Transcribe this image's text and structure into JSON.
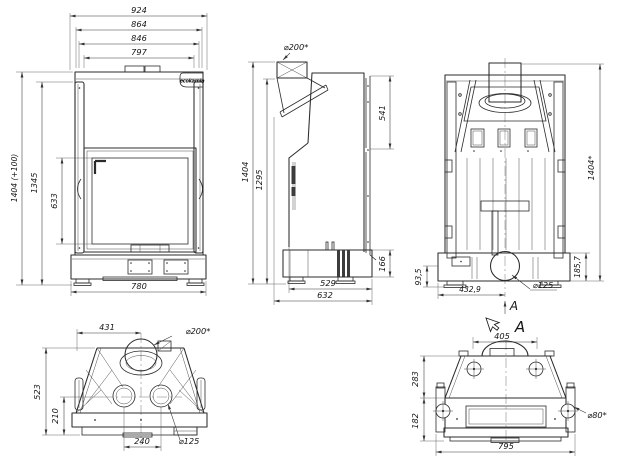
{
  "drawing": {
    "brand": "ecokamin",
    "front": {
      "total_width": "924",
      "width_2": "864",
      "width_3": "846",
      "width_4": "797",
      "total_height": "1404 (+100)",
      "height_2": "1345",
      "glass_height": "633",
      "base_width": "780"
    },
    "side": {
      "flue_dia": "⌀200*",
      "shield_height": "541",
      "total_height": "1404",
      "height_2": "1295",
      "base_height": "166",
      "base_depth": "529",
      "total_depth": "632"
    },
    "back": {
      "total_height": "1404*",
      "base_height": "185,7",
      "height_small": "93,5",
      "outlet_offset": "432,9",
      "outlet_dia": "⌀125",
      "section_label": "A"
    },
    "top": {
      "flue_offset": "431",
      "flue_dia": "⌀200*",
      "total_depth": "523",
      "depth_2": "210",
      "intake_spacing": "240",
      "intake_dia": "⌀125"
    },
    "section": {
      "view_label": "A",
      "hump_width": "405",
      "upper_height": "283",
      "lower_height": "182",
      "total_width": "795",
      "hole_dia": "⌀80*"
    }
  }
}
